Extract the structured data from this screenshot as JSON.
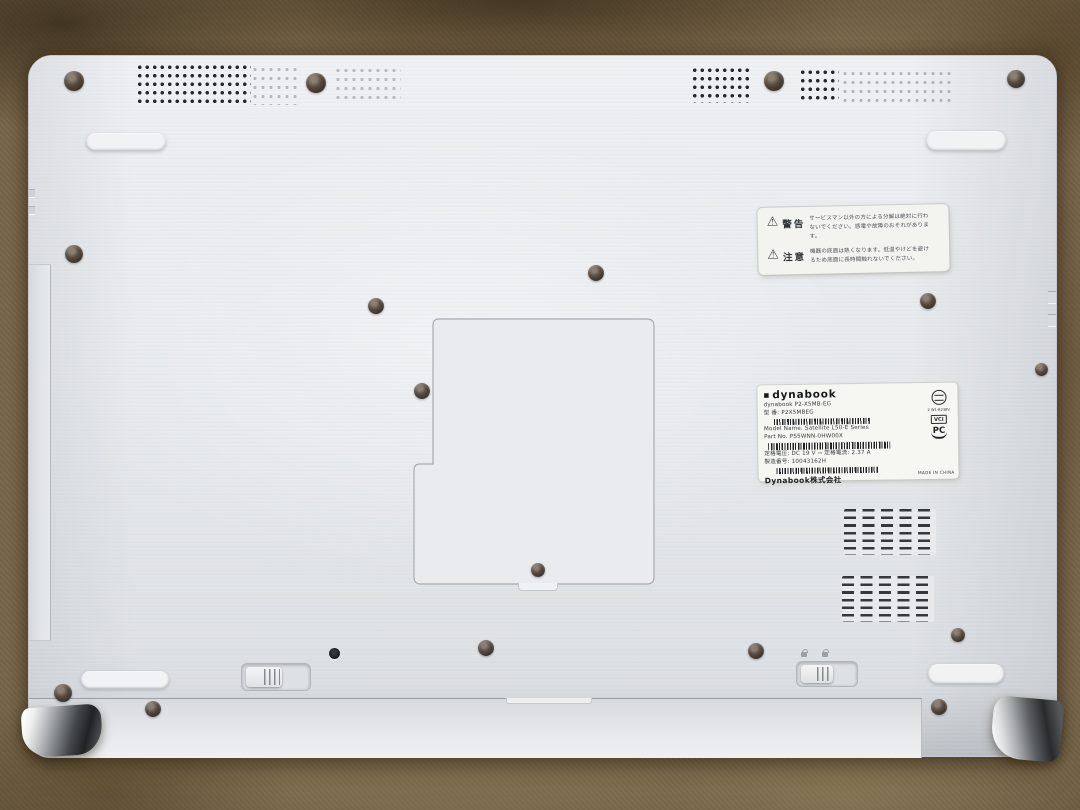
{
  "scene": {
    "description": "Bottom view of a white Dynabook laptop lying on tan carpet",
    "colors": {
      "carpet": "#8d7a5a",
      "carpet_dark": "#554228",
      "body": "#e7e9ec",
      "vent_hole": "#24272b",
      "screw": "#3a332c",
      "label_bg": "#f5f5f2",
      "chrome_dark": "#202224",
      "chrome_light": "#fdfdfd"
    }
  },
  "icons": {
    "warning_triangle_glyph": "⚠",
    "brand_mark_glyph": "◼"
  },
  "warning_label": {
    "rows": [
      {
        "title": "警告",
        "text": "サービスマン以外の方による分解は絶対に行わないでください。感電や故障のおそれがあります。"
      },
      {
        "title": "注意",
        "text": "機器の底面は熱くなります。低温やけどを避けるため底面に長時間触れないでください。"
      }
    ]
  },
  "spec_label": {
    "brand": "dynabook",
    "product_line": "dynabook P2-X5MB-EG",
    "model_no": "型 番: P2X5MBEG",
    "model_name": "Model Name. Satellite L50-E Series",
    "part_no": "Part No. PS5WNN-0HW00X",
    "rating": "定格電圧: DC 19 V ⎓  定格電流: 2.37 A",
    "serial": "製造番号: 10043162H",
    "company": "Dynabook株式会社",
    "made_in": "MADE IN CHINA",
    "cert_code": "2 W1-B23BV",
    "vcci_mark": "VCI",
    "pc_recycle": "PC"
  }
}
